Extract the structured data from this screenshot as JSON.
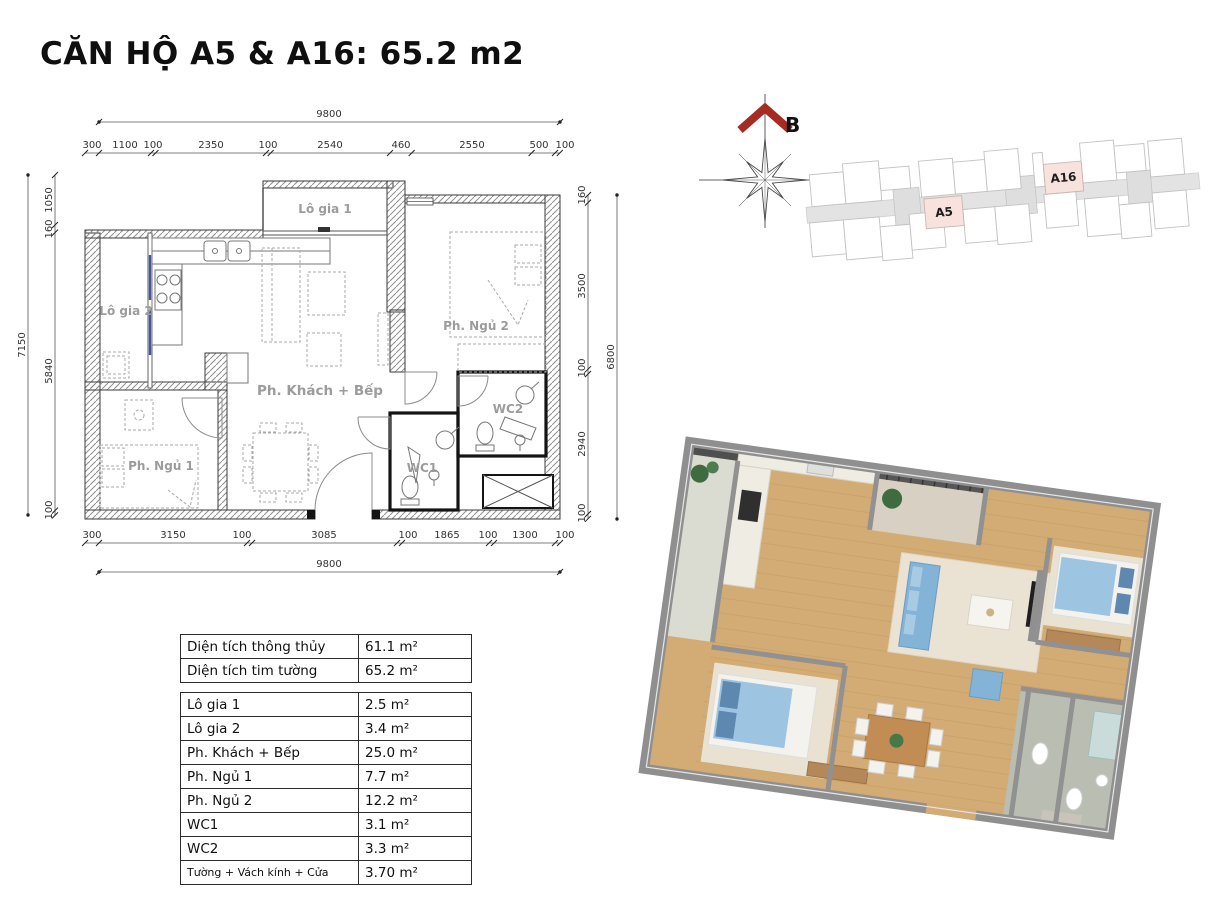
{
  "page": {
    "title": "CĂN HỘ A5 & A16: 65.2 m2"
  },
  "colors": {
    "unit_highlight": "#f7e2dd",
    "compass_arrow": "#a62b23",
    "sofa_blue": "#84b3d8",
    "wood_floor": "#d3ac75"
  },
  "compass": {
    "label": "B"
  },
  "site_plan": {
    "a5": "A5",
    "a16": "A16"
  },
  "floor_plan": {
    "rooms": {
      "logia1": "Lô gia 1",
      "logia2": "Lô gia 2",
      "living": "Ph. Khách + Bếp",
      "bed1": "Ph. Ngủ 1",
      "bed2": "Ph. Ngủ 2",
      "wc1": "WC1",
      "wc2": "WC2"
    },
    "dims": {
      "top_overall": "9800",
      "top": [
        "300",
        "1100",
        "100",
        "2350",
        "100",
        "2540",
        "460",
        "2550",
        "500",
        "100"
      ],
      "bottom": [
        "300",
        "3150",
        "100",
        "3085",
        "100",
        "1865",
        "100",
        "1300",
        "100"
      ],
      "bottom_overall": "9800",
      "left_overall": "7150",
      "left": [
        "1050",
        "160",
        "5840",
        "100"
      ],
      "right": [
        "160",
        "3500",
        "100",
        "2940",
        "100"
      ],
      "right_overall": "6800"
    }
  },
  "area_table": {
    "summary": [
      {
        "label": "Diện tích thông thủy",
        "value": "61.1 m²"
      },
      {
        "label": "Diện tích tim tường",
        "value": "65.2 m²"
      }
    ],
    "rooms": [
      {
        "label": "Lô gia 1",
        "value": "2.5 m²"
      },
      {
        "label": "Lô gia 2",
        "value": "3.4 m²"
      },
      {
        "label": "Ph. Khách + Bếp",
        "value": "25.0 m²"
      },
      {
        "label": "Ph. Ngủ 1",
        "value": "7.7 m²"
      },
      {
        "label": "Ph. Ngủ 2",
        "value": "12.2 m²"
      },
      {
        "label": "WC1",
        "value": "3.1 m²"
      },
      {
        "label": "WC2",
        "value": "3.3 m²"
      },
      {
        "label": "Tường + Vách kính + Cửa",
        "value": "3.70 m²"
      }
    ]
  }
}
